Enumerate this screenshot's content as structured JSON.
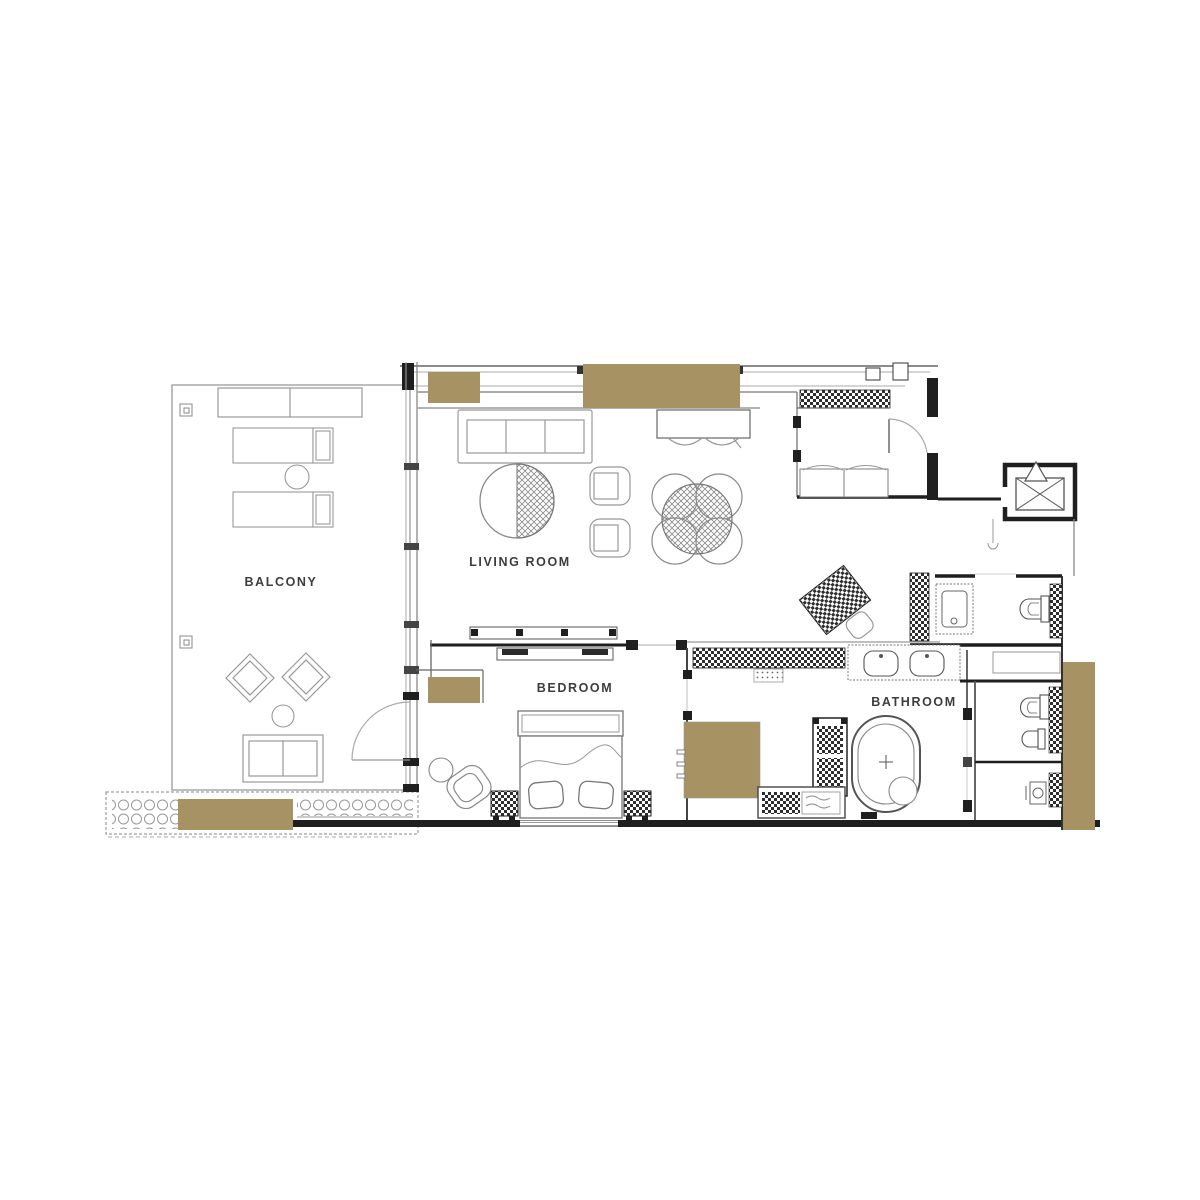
{
  "colors": {
    "background": "#ffffff",
    "gold_accent": "#a69262",
    "wall": "#1f1f1f",
    "line_mid": "#666666",
    "line_light": "#9a9a9a",
    "label_text": "#3d3d3d"
  },
  "rooms": {
    "balcony": {
      "label": "BALCONY"
    },
    "living": {
      "label": "LIVING ROOM"
    },
    "bedroom": {
      "label": "BEDROOM"
    },
    "bathroom": {
      "label": "BATHROOM"
    }
  }
}
